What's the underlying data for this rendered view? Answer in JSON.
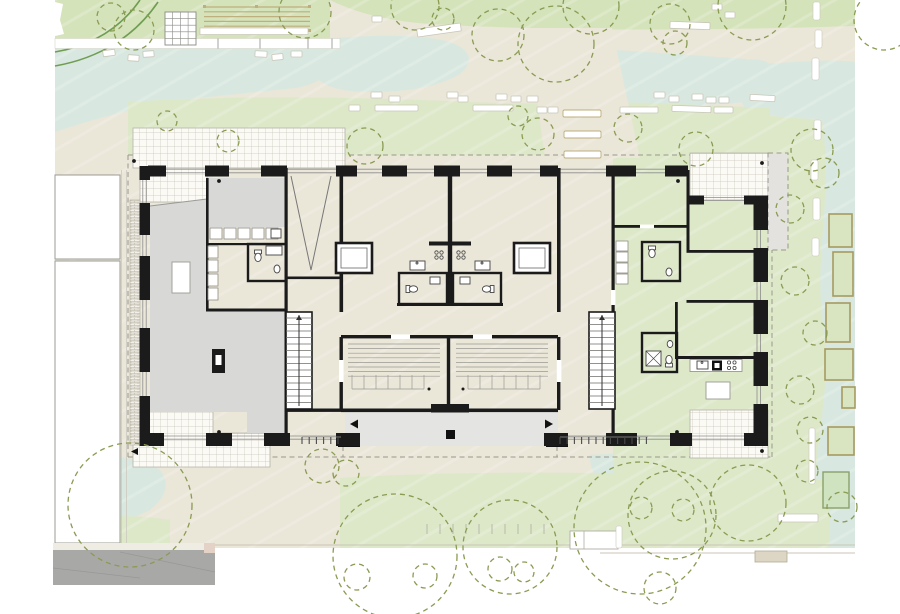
{
  "palette": {
    "beige": "#eae6d8",
    "mint": "#d8e8e0",
    "lawn": "#dde8c9",
    "lawn2": "#d5e3bb",
    "tree": "#8a9b52",
    "hedge": "#6f9e53",
    "tan": "#bfae7e",
    "bedBorder": "#a69a60",
    "bedFill": "#d9e5c1",
    "sand": "#cfe3c0",
    "sandBorder": "#8aa06a",
    "wall": "#1b1b1b",
    "roomGray": "#d8d8d6",
    "arcade": "#e4e4e2",
    "overhang": "#e3e2de",
    "tileLine": "#c7c5b9",
    "glass": "#8d8d8d",
    "road": "#a8a8a6",
    "roadTop": "#efece3",
    "pink": "#e5d2c6",
    "dash": "#9a988c",
    "stoneStroke": "#c9c6b8",
    "thin": "#777777",
    "fixture": "#444444",
    "dot": "#1a1a1a",
    "tick": "#b9b8ab",
    "railTick": "#4a4a4a",
    "pathLine": "#c9c6b6",
    "stepFill": "#ddd6c4",
    "stepStroke": "#b3ac94",
    "grayLine": "#9a9a9a"
  },
  "trees": [
    [
      111,
      17,
      14
    ],
    [
      134,
      30,
      20
    ],
    [
      305,
      12,
      26
    ],
    [
      415,
      6,
      24
    ],
    [
      443,
      19,
      11
    ],
    [
      498,
      35,
      26
    ],
    [
      556,
      44,
      38
    ],
    [
      591,
      6,
      28
    ],
    [
      670,
      24,
      20
    ],
    [
      675,
      43,
      12
    ],
    [
      752,
      6,
      34
    ],
    [
      884,
      20,
      30
    ],
    [
      167,
      121,
      10
    ],
    [
      228,
      141,
      11
    ],
    [
      365,
      146,
      18
    ],
    [
      518,
      116,
      10
    ],
    [
      538,
      134,
      16
    ],
    [
      628,
      128,
      14
    ],
    [
      696,
      149,
      17
    ],
    [
      812,
      150,
      21
    ],
    [
      824,
      173,
      15
    ],
    [
      790,
      209,
      14
    ],
    [
      795,
      281,
      14
    ],
    [
      815,
      333,
      12
    ],
    [
      800,
      390,
      14
    ],
    [
      810,
      430,
      13
    ],
    [
      130,
      505,
      62
    ],
    [
      322,
      466,
      17
    ],
    [
      346,
      473,
      13
    ],
    [
      395,
      556,
      62
    ],
    [
      510,
      547,
      47
    ],
    [
      640,
      528,
      66
    ],
    [
      672,
      515,
      44
    ],
    [
      748,
      503,
      38
    ],
    [
      641,
      508,
      11
    ],
    [
      683,
      510,
      11
    ],
    [
      807,
      471,
      11
    ],
    [
      842,
      507,
      15
    ],
    [
      357,
      577,
      13
    ],
    [
      425,
      576,
      12
    ],
    [
      500,
      569,
      12
    ],
    [
      524,
      572,
      10
    ],
    [
      660,
      588,
      16
    ]
  ],
  "stones": [
    [
      103,
      50,
      12,
      6,
      -8
    ],
    [
      128,
      55,
      11,
      6,
      4
    ],
    [
      143,
      51,
      11,
      6,
      -4
    ],
    [
      255,
      51,
      12,
      6,
      3
    ],
    [
      272,
      54,
      11,
      6,
      -5
    ],
    [
      291,
      51,
      11,
      6,
      0
    ],
    [
      349,
      105,
      11,
      6,
      0
    ],
    [
      371,
      92,
      11,
      6,
      0
    ],
    [
      389,
      96,
      11,
      6,
      0
    ],
    [
      447,
      92,
      11,
      6,
      0
    ],
    [
      458,
      96,
      10,
      6,
      0
    ],
    [
      496,
      94,
      11,
      6,
      0
    ],
    [
      511,
      96,
      10,
      6,
      0
    ],
    [
      527,
      96,
      11,
      6,
      0
    ],
    [
      537,
      107,
      10,
      6,
      0
    ],
    [
      548,
      107,
      10,
      6,
      0
    ],
    [
      654,
      92,
      11,
      6,
      0
    ],
    [
      669,
      96,
      10,
      6,
      0
    ],
    [
      692,
      94,
      11,
      6,
      0
    ],
    [
      706,
      97,
      10,
      6,
      0
    ],
    [
      719,
      97,
      10,
      6,
      0
    ],
    [
      712,
      4,
      10,
      6,
      0
    ],
    [
      725,
      12,
      10,
      6,
      0
    ],
    [
      372,
      16,
      10,
      6,
      0
    ]
  ],
  "benches": [
    [
      417,
      26,
      44,
      8,
      -8
    ],
    [
      670,
      22,
      40,
      7,
      2
    ],
    [
      375,
      105,
      43,
      6,
      0
    ],
    [
      473,
      105,
      40,
      6,
      0
    ],
    [
      620,
      107,
      38,
      6,
      0
    ],
    [
      672,
      106,
      39,
      6,
      2
    ],
    [
      714,
      107,
      19,
      6,
      0
    ],
    [
      750,
      95,
      25,
      6,
      3
    ],
    [
      778,
      514,
      40,
      8,
      0
    ]
  ],
  "center_steps": [
    [
      563,
      110,
      38,
      7
    ],
    [
      564,
      131,
      37,
      7
    ],
    [
      564,
      151,
      37,
      7
    ]
  ],
  "path_segments": [
    [
      813,
      2,
      7,
      18
    ],
    [
      815,
      30,
      7,
      18
    ],
    [
      812,
      58,
      7,
      22
    ],
    [
      814,
      120,
      7,
      20
    ],
    [
      811,
      160,
      7,
      20
    ],
    [
      813,
      198,
      7,
      22
    ],
    [
      812,
      238,
      7,
      18
    ],
    [
      809,
      428,
      6,
      56
    ],
    [
      616,
      526,
      6,
      22
    ]
  ],
  "garden_beds": [
    [
      829,
      214,
      23,
      33
    ],
    [
      833,
      252,
      20,
      44
    ],
    [
      826,
      303,
      24,
      39
    ],
    [
      825,
      349,
      28,
      31
    ],
    [
      842,
      387,
      13,
      21
    ],
    [
      828,
      427,
      26,
      28
    ]
  ],
  "sandbox": [
    823,
    472,
    26,
    36
  ],
  "dots": [
    [
      219,
      181
    ],
    [
      678,
      181
    ],
    [
      219,
      432
    ],
    [
      677,
      432
    ],
    [
      762,
      163
    ],
    [
      762,
      451
    ],
    [
      134,
      161
    ]
  ],
  "grass_ticks": {
    "y": 524,
    "h": 10,
    "from": 427,
    "to": 547,
    "step": 13
  },
  "rail_ticks": [
    {
      "y": 437,
      "h": 7,
      "from": 302,
      "to": 341,
      "step": 7.2
    },
    {
      "y": 437,
      "h": 7,
      "from": 560,
      "to": 648,
      "step": 7.2
    }
  ],
  "building": {
    "north_piers": {
      "y": 165.5,
      "h": 11,
      "segs": [
        [
          148,
          18
        ],
        [
          205,
          24
        ],
        [
          261,
          26
        ],
        [
          336,
          21
        ],
        [
          382,
          25
        ],
        [
          434,
          26
        ],
        [
          487,
          25
        ],
        [
          540,
          18
        ],
        [
          606,
          30
        ],
        [
          665,
          23
        ]
      ]
    },
    "ne_piers": {
      "y": 195.5,
      "h": 9,
      "segs": [
        [
          688,
          16
        ],
        [
          744,
          24
        ]
      ]
    },
    "south_piers": {
      "y": 433,
      "h": 13,
      "segs": [
        [
          148,
          16
        ],
        [
          206,
          26
        ],
        [
          264,
          26
        ],
        [
          336,
          24
        ],
        [
          544,
          24
        ],
        [
          606,
          31
        ],
        [
          670,
          22
        ],
        [
          744,
          24
        ]
      ]
    },
    "west_piers": {
      "x": 139.5,
      "w": 10.5,
      "segs": [
        [
          166,
          14
        ],
        [
          203,
          32
        ],
        [
          256,
          44
        ],
        [
          328,
          44
        ],
        [
          396,
          34
        ],
        [
          430,
          16
        ]
      ]
    },
    "east_piers": {
      "x": 753.5,
      "w": 14.5,
      "segs": [
        [
          200,
          30
        ],
        [
          248,
          34
        ],
        [
          300,
          34
        ],
        [
          352,
          34
        ],
        [
          404,
          29
        ]
      ]
    },
    "stairs": [
      [
        286,
        312,
        26,
        97
      ],
      [
        589,
        312,
        26,
        97
      ]
    ],
    "bike_rooms": [
      [
        344,
        340,
        100,
        66
      ],
      [
        452,
        340,
        100,
        66
      ]
    ]
  }
}
